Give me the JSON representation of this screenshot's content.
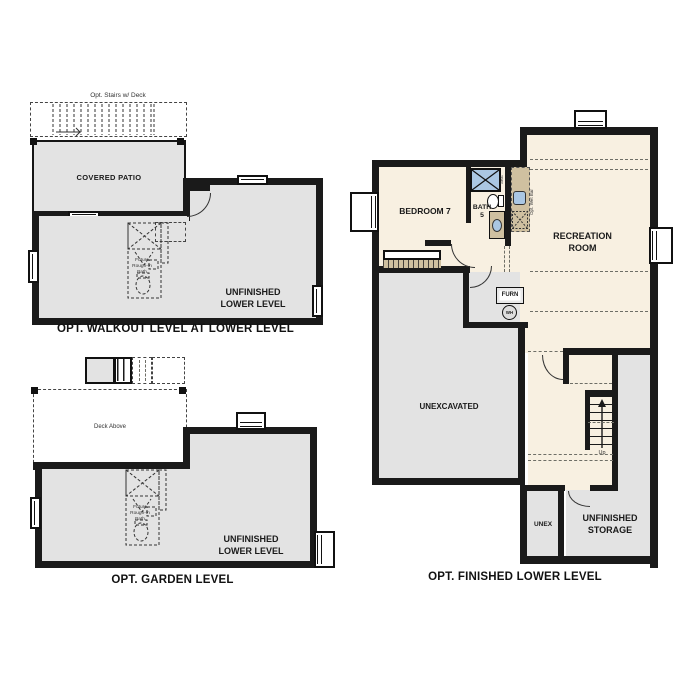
{
  "colors": {
    "wall": "#1a1a1a",
    "room_gray": "#e3e3e3",
    "room_cream": "#f8f0e1",
    "counter_tan": "#cfc0a0",
    "fixture_blue": "#aac7e3",
    "background": "#ffffff"
  },
  "plans": {
    "walkout": {
      "caption": "OPT. WALKOUT LEVEL AT LOWER LEVEL",
      "stairs_note": "Opt. Stairs w/ Deck",
      "patio_label": "COVERED PATIO",
      "room_label": "UNFINISHED\nLOWER LEVEL",
      "bath_note": "Future\nRough-In\nBath"
    },
    "garden": {
      "caption": "OPT. GARDEN LEVEL",
      "deck_label": "Deck Above",
      "room_label": "UNFINISHED\nLOWER LEVEL",
      "bath_note": "Future\nRough-In\nBath"
    },
    "finished": {
      "caption": "OPT. FINISHED LOWER LEVEL",
      "bedroom_label": "BEDROOM 7",
      "bath_label": "BATH\n5",
      "seat_label": "Seat",
      "wet_bar_label": "Opt. Wet Bar",
      "recreation_label": "RECREATION\nROOM",
      "furnace_label": "FURN",
      "water_heater_label": "WH",
      "unexcavated_label": "UNEXCAVATED",
      "stairs_up_label": "Up",
      "unex_label": "UNEX",
      "storage_label": "UNFINISHED\nSTORAGE"
    }
  }
}
